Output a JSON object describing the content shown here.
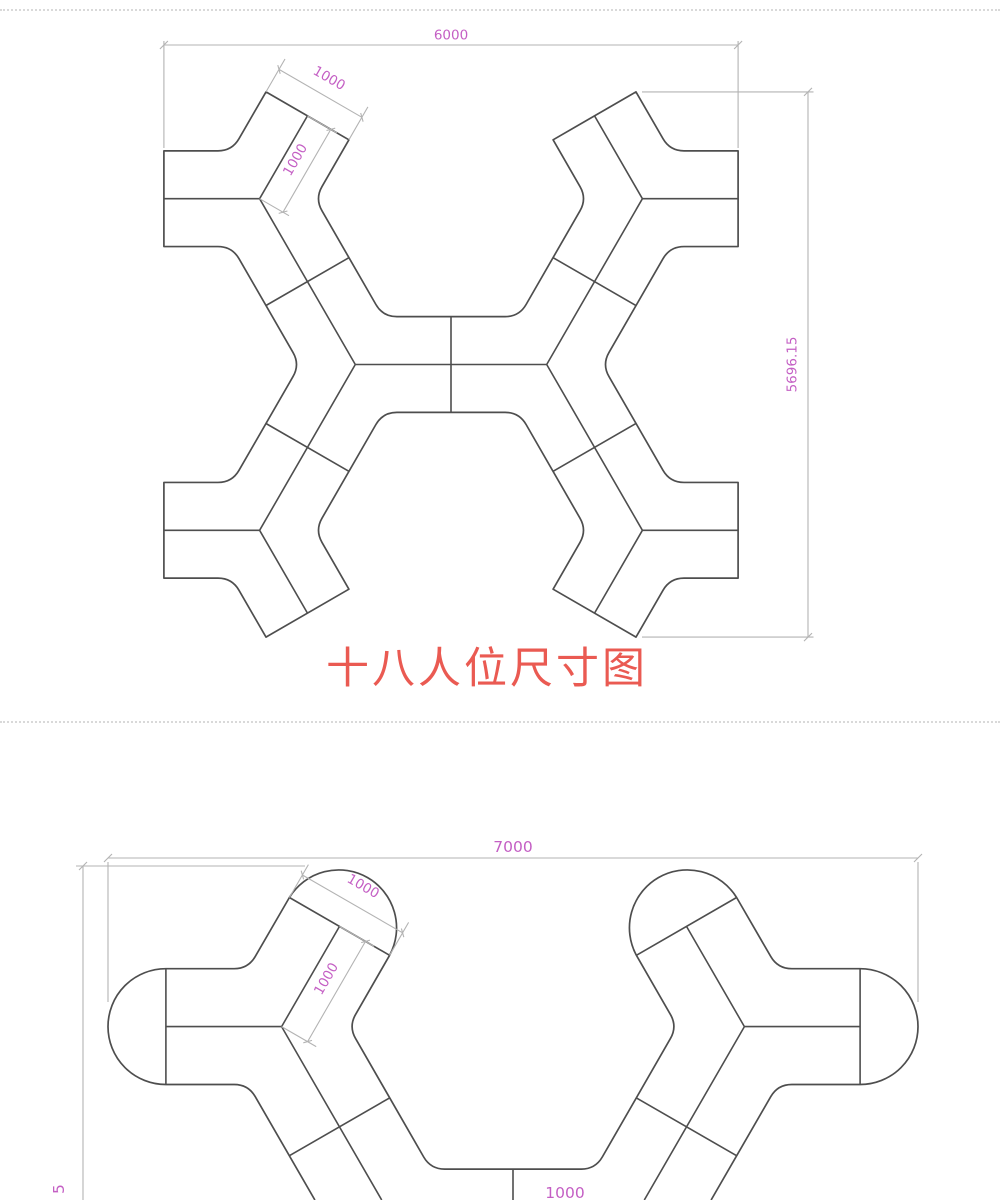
{
  "colors": {
    "outline": "#4e4e4e",
    "dimension_line": "#b3b3b3",
    "dimension_text": "#c45fc4",
    "title": "#ea5a52",
    "separator": "#d9d9d9",
    "background": "#ffffff"
  },
  "top_diagram": {
    "title": "十八人位尺寸图",
    "dim_width": "6000",
    "dim_height": "5696.15",
    "dim_desk_edge": "1000",
    "dim_desk_depth": "1000"
  },
  "bottom_diagram": {
    "dim_width": "7000",
    "dim_desk_edge": "1000",
    "dim_desk_depth": "1000",
    "dim_center": "1000",
    "dim_left_partial": "5"
  }
}
